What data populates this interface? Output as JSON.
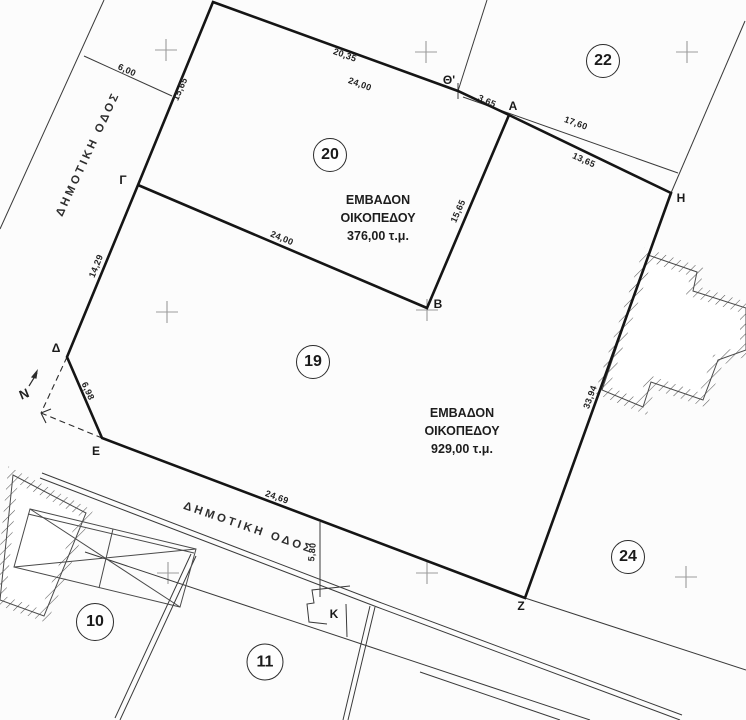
{
  "plots": [
    {
      "number": "20"
    },
    {
      "number": "22"
    },
    {
      "number": "19"
    },
    {
      "number": "24"
    },
    {
      "number": "10"
    },
    {
      "number": "11"
    }
  ],
  "vertices": [
    {
      "label": "Θ'"
    },
    {
      "label": "Α"
    },
    {
      "label": "Γ"
    },
    {
      "label": "Β"
    },
    {
      "label": "Η"
    },
    {
      "label": "Δ"
    },
    {
      "label": "Ε"
    },
    {
      "label": "Ζ"
    },
    {
      "label": "Κ"
    }
  ],
  "dimensions": [
    {
      "value": "20,35"
    },
    {
      "value": "24,00"
    },
    {
      "value": "15,65"
    },
    {
      "value": "3,65"
    },
    {
      "value": "17,60"
    },
    {
      "value": "13,65"
    },
    {
      "value": "15,65"
    },
    {
      "value": "24,00"
    },
    {
      "value": "14,29"
    },
    {
      "value": "6,98"
    },
    {
      "value": "24,69"
    },
    {
      "value": "33,94"
    },
    {
      "value": "5,80"
    },
    {
      "value": "6,00"
    }
  ],
  "areas": [
    {
      "text": "ΕΜΒΑΔΟΝ\nΟΙΚΟΠΕΔΟΥ\n376,00 τ.μ."
    },
    {
      "text": "ΕΜΒΑΔΟΝ\nΟΙΚΟΠΕΔΟΥ\n929,00 τ.μ."
    }
  ],
  "roads": [
    {
      "label": "ΔΗΜΟΤΙΚΗ ΟΔΟΣ"
    },
    {
      "label": "ΔΗΜΟΤΙΚΗ ΟΔΟΣ"
    }
  ],
  "north": {
    "label": "N"
  },
  "colors": {
    "boundary_line": "#151515",
    "thin_line": "#3a3a3a",
    "grid_cross": "#9b9b9b",
    "background": "#fcfcfc"
  }
}
